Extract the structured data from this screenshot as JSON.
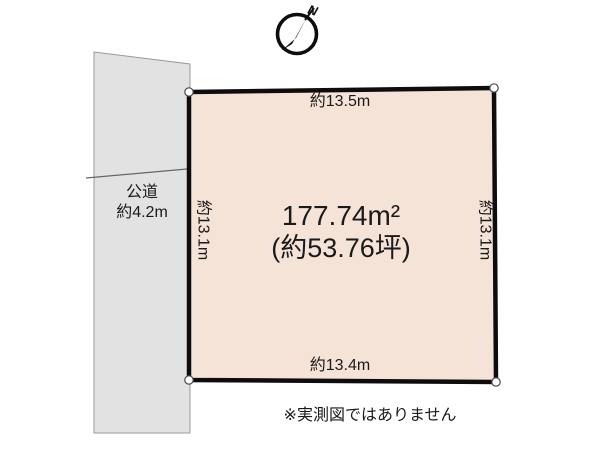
{
  "compass": {
    "north_label": "N"
  },
  "road": {
    "label_line1": "公道",
    "label_line2": "約4.2m"
  },
  "plot": {
    "area_m2": "177.74m²",
    "area_tsubo": "(約53.76坪)",
    "top_length": "約13.5m",
    "bottom_length": "約13.4m",
    "left_length": "約13.1m",
    "right_length": "約13.1m"
  },
  "note": {
    "disclaimer": "※実測図ではありません"
  },
  "colors": {
    "plot_fill": "#f6e3d8",
    "plot_border": "#0d0d0d",
    "road_fill": "#e2e2e2",
    "road_border": "#999999",
    "text": "#1a1a1a"
  }
}
